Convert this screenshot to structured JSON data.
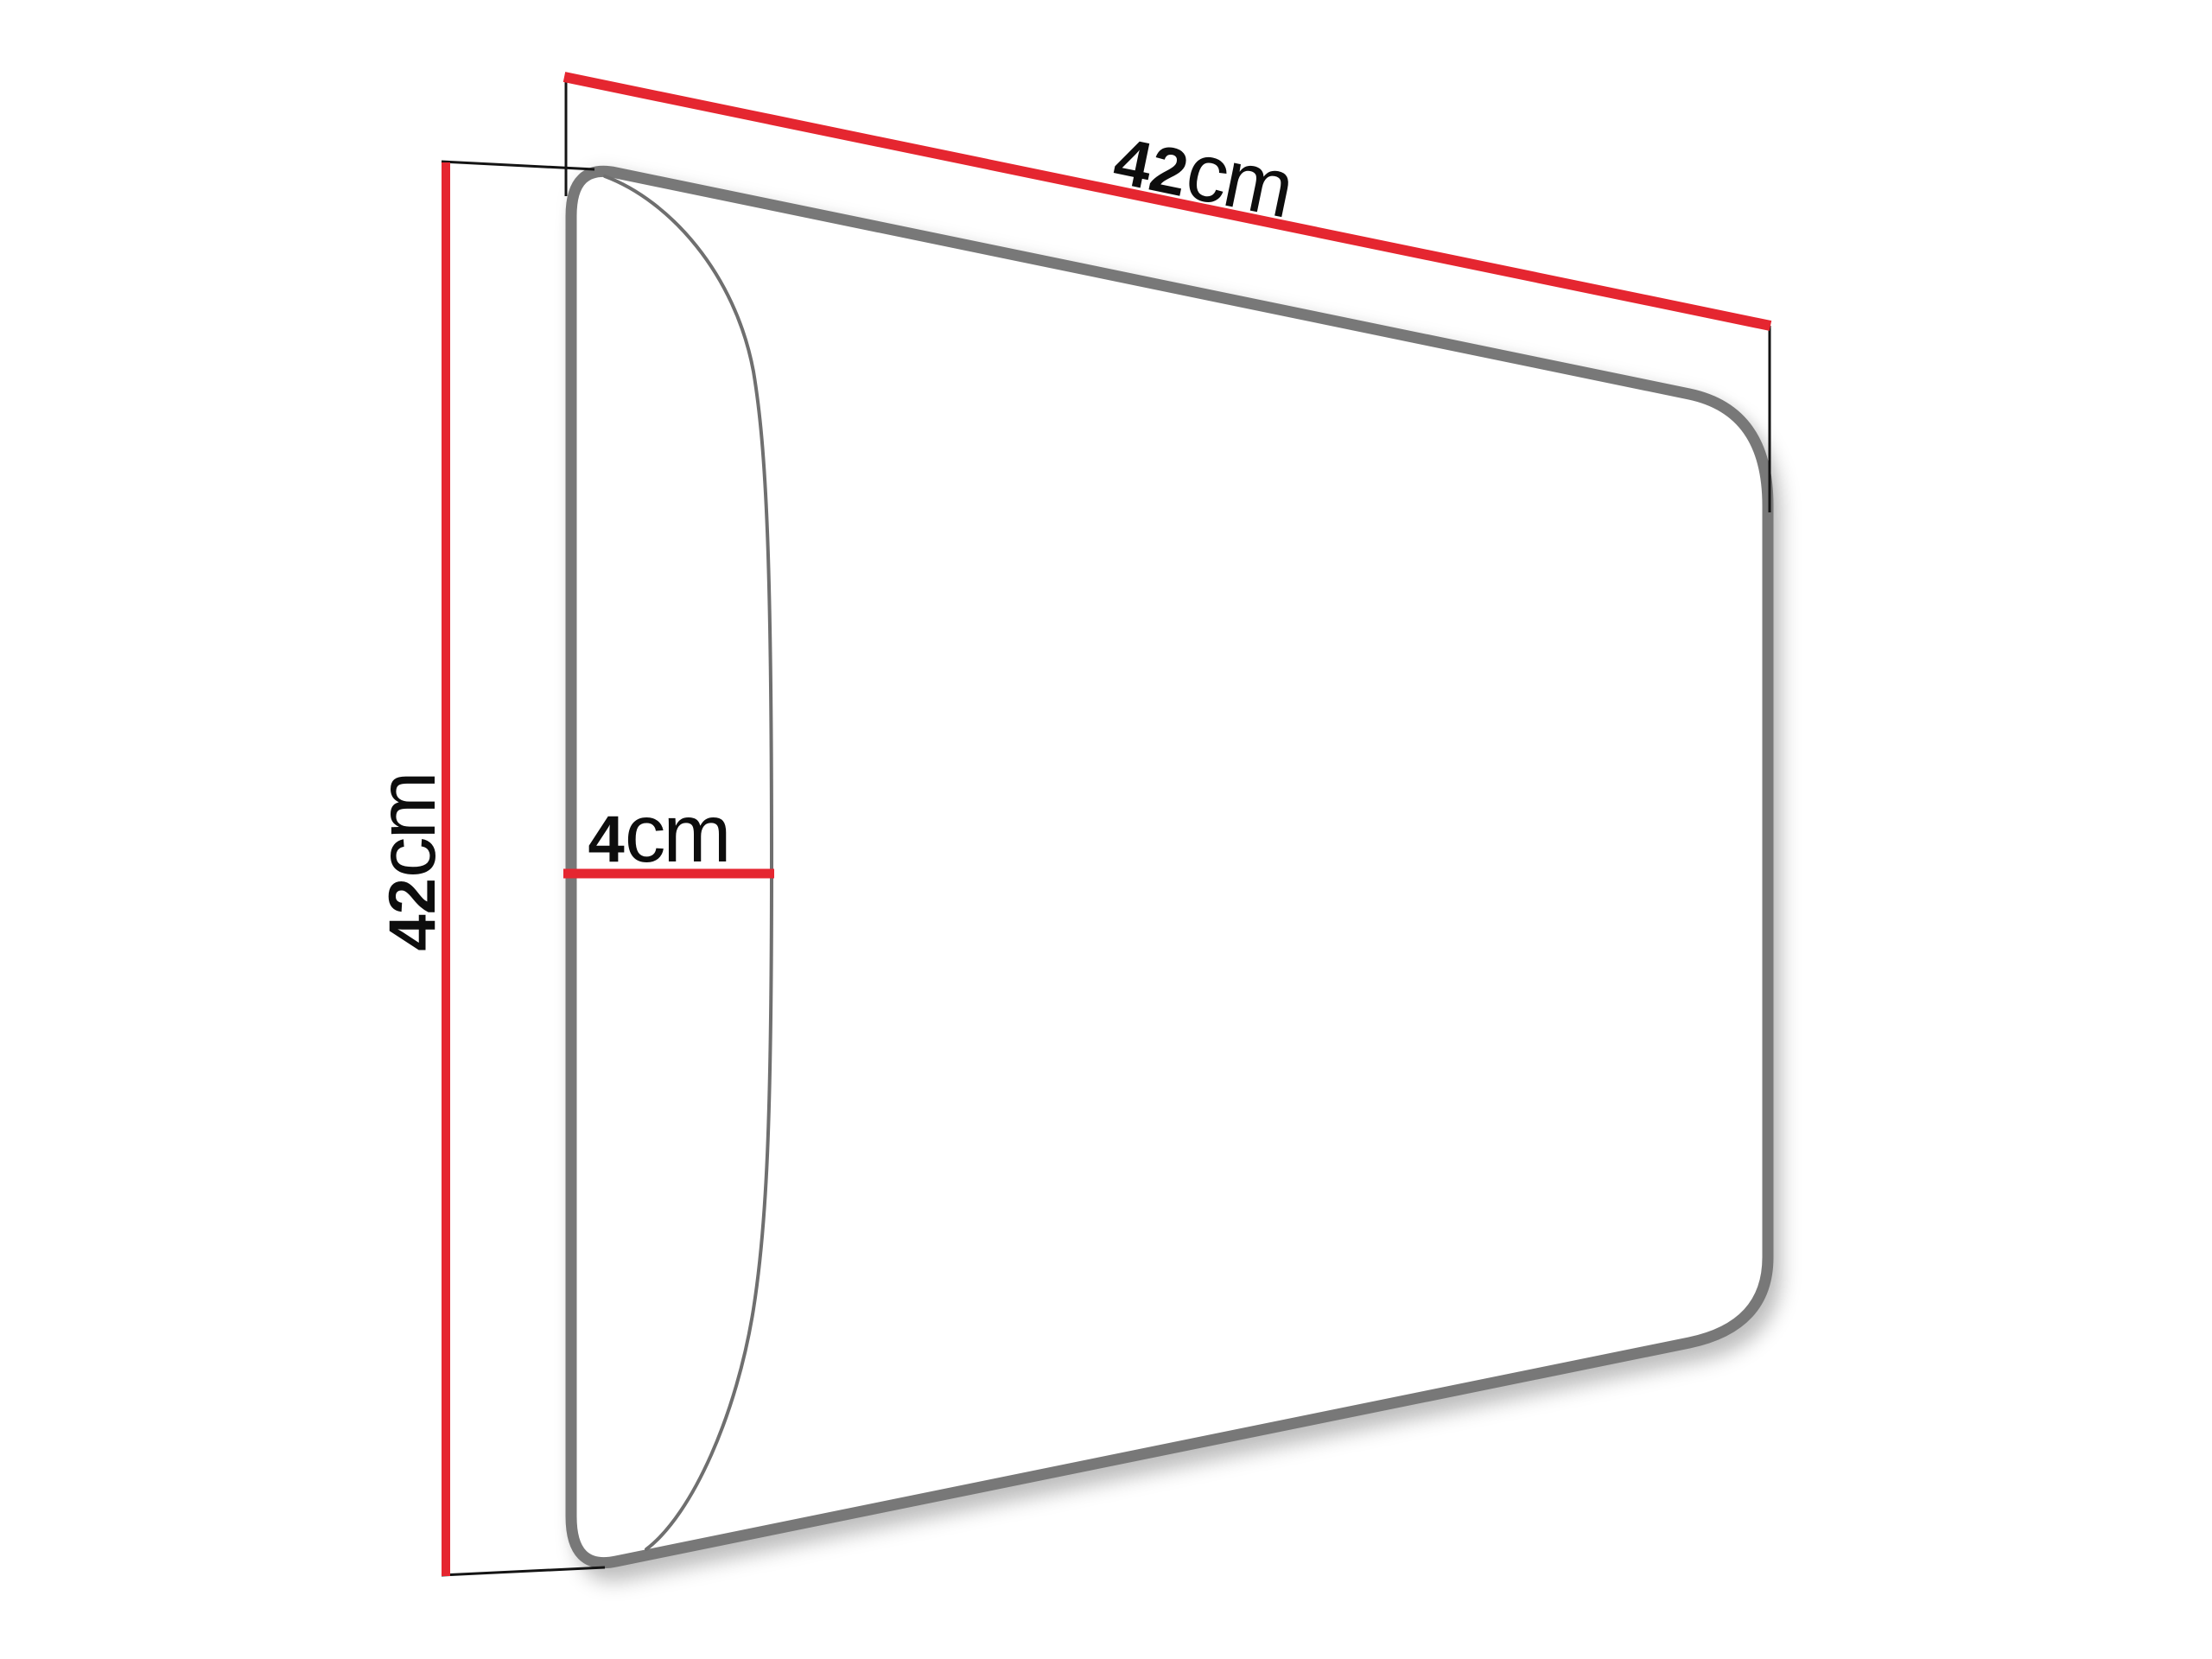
{
  "colors": {
    "background": "#ffffff",
    "dimension_red": "#e52630",
    "outline_gray": "#787878",
    "curve_gray": "#6f6f6f",
    "extension_black": "#141414",
    "label_black": "#0d0d0d"
  },
  "dimensions": {
    "width": {
      "value": "42",
      "unit": "cm"
    },
    "height": {
      "value": "42",
      "unit": "cm"
    },
    "depth": {
      "value": "4",
      "unit": "cm"
    }
  }
}
